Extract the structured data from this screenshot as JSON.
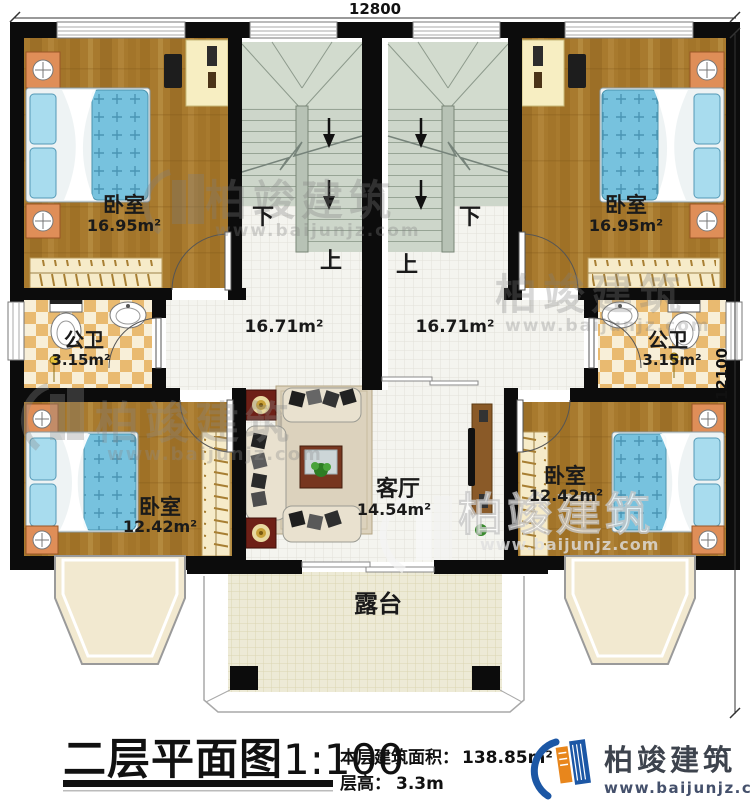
{
  "dimensions": {
    "top": "12800",
    "right": "12100"
  },
  "rooms": {
    "bedroom_top_left": {
      "label": "卧室",
      "area": "16.95m²"
    },
    "bedroom_top_right": {
      "label": "卧室",
      "area": "16.95m²"
    },
    "bath_left": {
      "label": "公卫",
      "area": "3.15m²"
    },
    "bath_right": {
      "label": "公卫",
      "area": "3.15m²"
    },
    "hall_left": {
      "area": "16.71m²"
    },
    "hall_right": {
      "area": "16.71m²"
    },
    "living_room": {
      "label": "客厅",
      "area": "14.54m²"
    },
    "bedroom_bottom_left": {
      "label": "卧室",
      "area": "12.42m²"
    },
    "bedroom_bottom_right": {
      "label": "卧室",
      "area": "12.42m²"
    },
    "terrace": {
      "label": "露台"
    }
  },
  "stairs": {
    "down": "下",
    "up": "上"
  },
  "title_block": {
    "title": "二层平面图",
    "scale": "1:100",
    "area_label": "本层建筑面积：",
    "area_value": "138.85m²",
    "height_label": "层高：",
    "height_value": "3.3m"
  },
  "branding": {
    "name": "柏竣建筑",
    "url": "www.baijunjz.com"
  },
  "watermark": {
    "name": "柏竣建筑",
    "url": "www.baijunjz.com"
  }
}
